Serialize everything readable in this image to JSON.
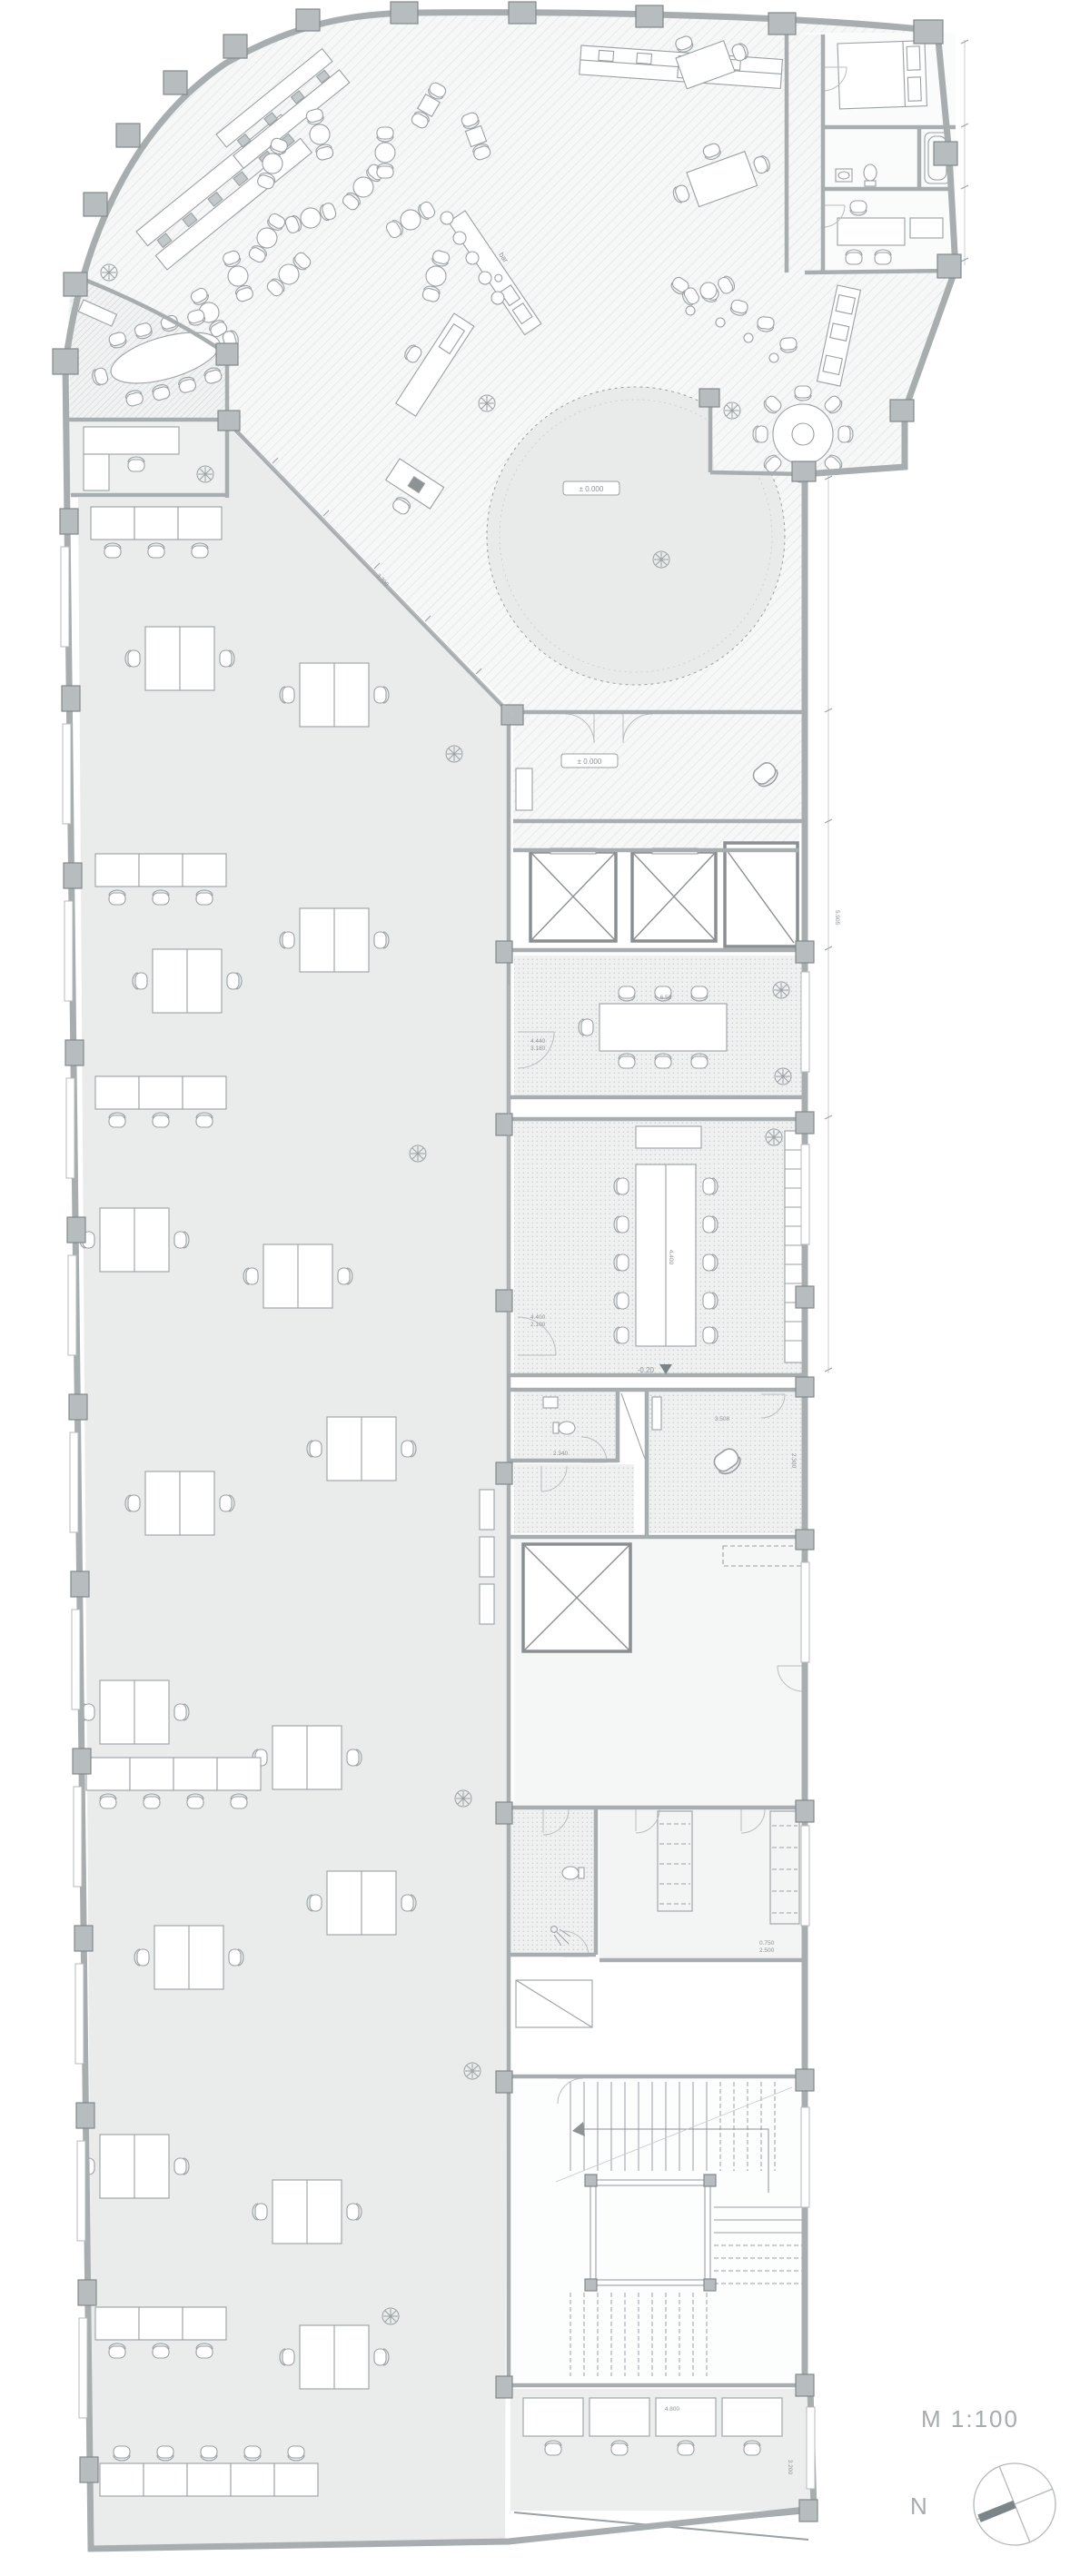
{
  "drawing": {
    "scale_label": "M 1:100",
    "north_label": "N"
  },
  "levels": {
    "lobby": "± 0.000",
    "vestibule": "± 0.000",
    "conference": "-0.20"
  },
  "labels": {
    "bar": "bar"
  },
  "dims": {
    "conf_table": "4.400",
    "conf_door_w": "4.400",
    "conf_door_h": "2.100",
    "meet_table": "6.50",
    "meet_door_w": "4.440",
    "meet_door_h": "3.180",
    "wc": "2.340",
    "guest_w": "3.508",
    "guest_h": "2.300",
    "closet_w": "0.750",
    "closet_h": "2.500",
    "office_w": "4.800",
    "office_h": "3.200",
    "corridor": "3.700",
    "hall": "5.905"
  },
  "colors": {
    "wall": "#a8adaf",
    "column": "#b7bcbe",
    "office_floor": "#e9eceb",
    "hatch_line": "#d8dcde",
    "furniture_line": "#9aa0a3",
    "text": "#8d9295",
    "needle": "#7d8487"
  }
}
